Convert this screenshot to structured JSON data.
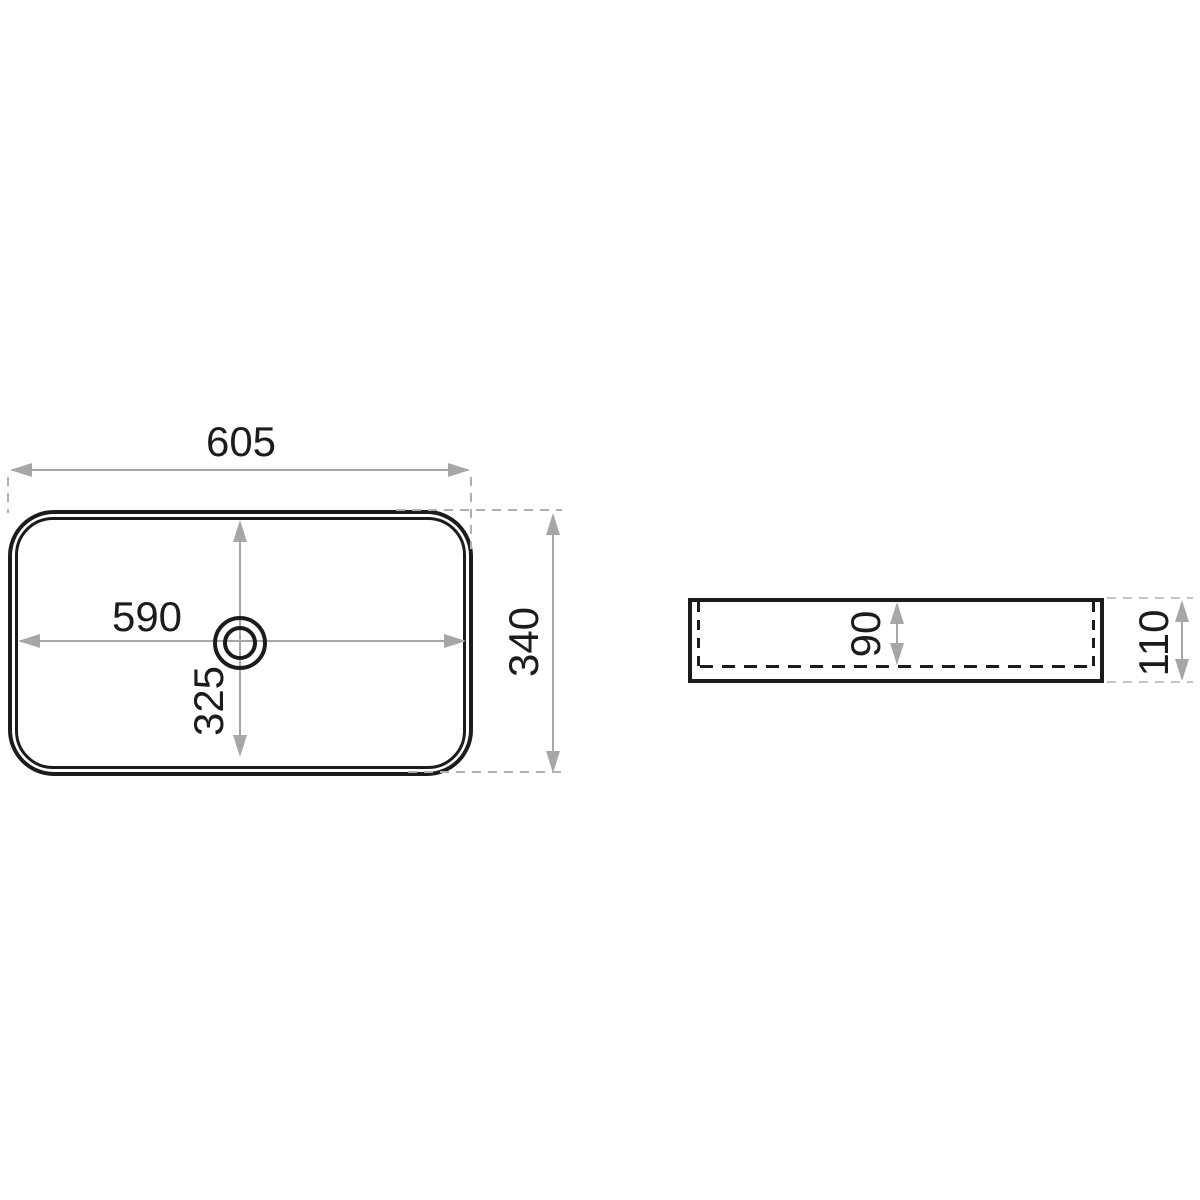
{
  "plan_view": {
    "dim_width_overall": "605",
    "dim_width_inner": "590",
    "dim_depth_inner": "325",
    "dim_depth_overall": "340"
  },
  "side_view": {
    "dim_bowl_depth": "90",
    "dim_height_overall": "110"
  },
  "colors": {
    "line_black": "#1c1c1c",
    "dim_gray": "#a6a6a6",
    "ext_gray": "#b0b0b0",
    "ext_gray_light": "#c6c6c6",
    "background": "#ffffff"
  }
}
